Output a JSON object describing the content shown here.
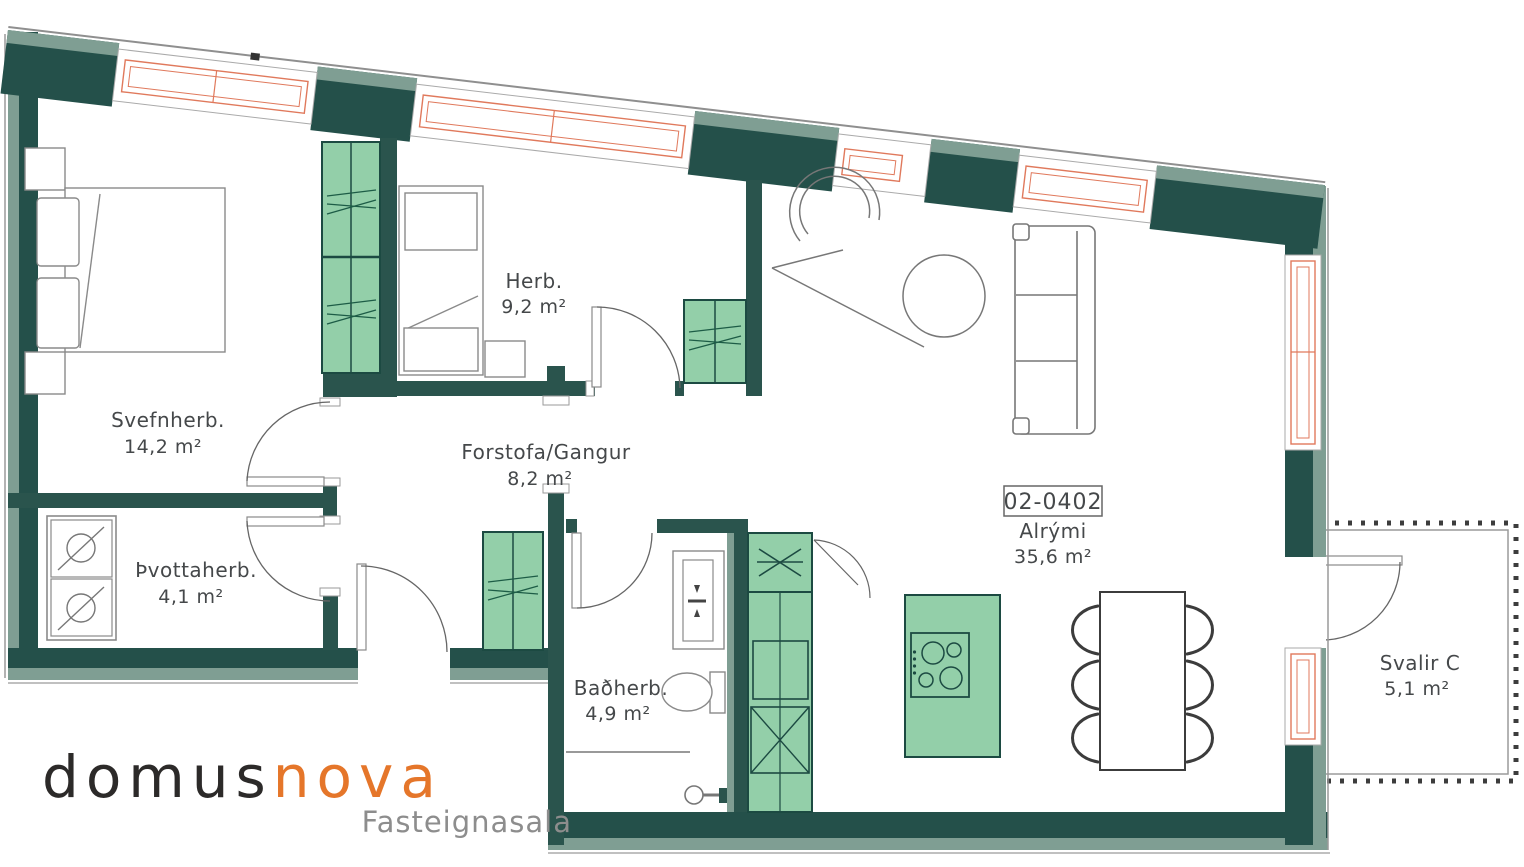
{
  "plan": {
    "unit_label": "02-0402",
    "rooms": [
      {
        "name": "Svefnherb.",
        "area": "14,2 m²"
      },
      {
        "name": "Herb.",
        "area": "9,2 m²"
      },
      {
        "name": "Forstofa/Gangur",
        "area": "8,2 m²"
      },
      {
        "name": "Þvottaherb.",
        "area": "4,1 m²"
      },
      {
        "name": "Baðherb.",
        "area": "4,9 m²"
      },
      {
        "name": "Alrými",
        "area": "35,6 m²"
      },
      {
        "name": "Svalir C",
        "area": "5,1 m²"
      }
    ]
  },
  "logo": {
    "brand_primary": "domus",
    "brand_accent": "nova",
    "tagline": "Fasteignasala"
  },
  "colors": {
    "wall_dark": "#24504a",
    "wall_sage": "#7f9e93",
    "furniture_green": "#93cfa9",
    "furniture_green_line": "#1d5c46",
    "window_frame": "#e0795c",
    "accent_orange": "#e5762a",
    "label_text": "#45484a"
  }
}
